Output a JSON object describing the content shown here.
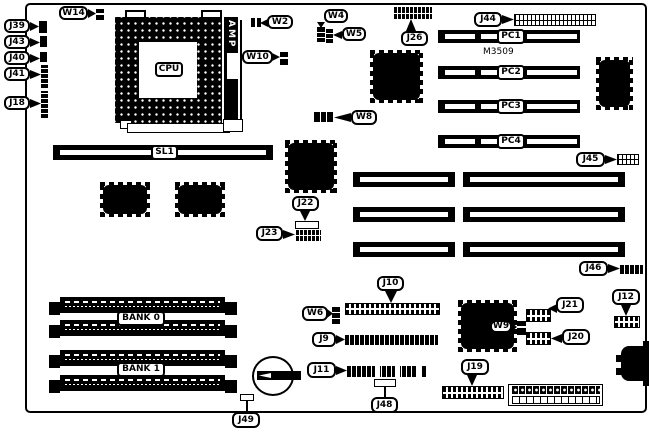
{
  "diagram": {
    "cpu": "CPU",
    "amp": "AMP",
    "chip_marking": "M3509",
    "slot_sl1": "SL1",
    "pci_slots": [
      "PC1",
      "PC2",
      "PC3",
      "PC4"
    ],
    "banks": [
      "BANK 0",
      "BANK 1"
    ],
    "callouts": {
      "w14": "W14",
      "j39": "J39",
      "j43": "J43",
      "j40": "J40",
      "j41": "J41",
      "j18": "J18",
      "w2": "W2",
      "w10": "W10",
      "w4": "W4",
      "w5": "W5",
      "w8": "W8",
      "j26": "J26",
      "j44": "J44",
      "j45": "J45",
      "j46": "J46",
      "j22": "J22",
      "j23": "J23",
      "j10": "J10",
      "w6": "W6",
      "j9": "J9",
      "j11": "J11",
      "j48": "J48",
      "j49": "J49",
      "j19": "J19",
      "w9": "W9",
      "j21": "J21",
      "j20": "J20",
      "j12": "J12"
    },
    "colors": {
      "ink": "#000000",
      "paper": "#ffffff"
    }
  }
}
